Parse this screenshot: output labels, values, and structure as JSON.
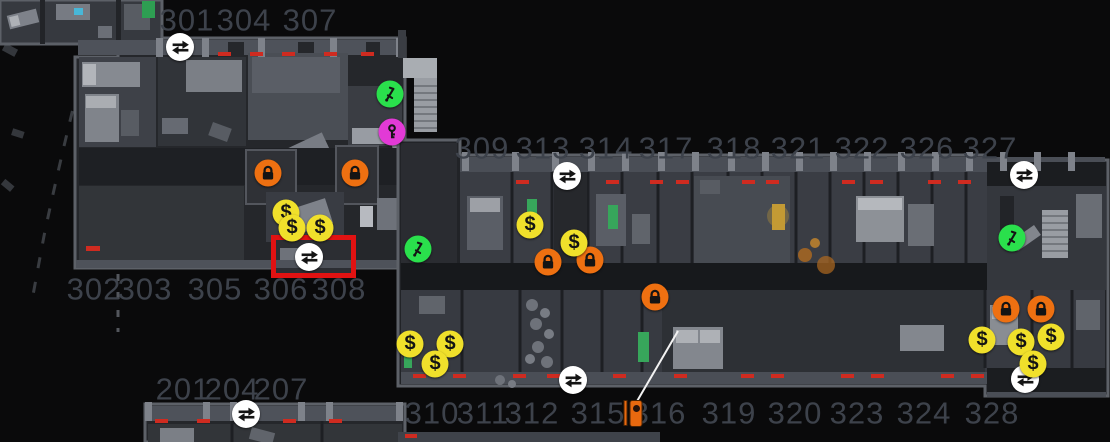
{
  "map": {
    "background": "#0a0a0b",
    "room_labels": [
      {
        "text": "301",
        "x": 187,
        "y": 20
      },
      {
        "text": "304",
        "x": 244,
        "y": 20
      },
      {
        "text": "307",
        "x": 310,
        "y": 20
      },
      {
        "text": "309",
        "x": 482,
        "y": 148
      },
      {
        "text": "313",
        "x": 543,
        "y": 148
      },
      {
        "text": "314",
        "x": 606,
        "y": 148
      },
      {
        "text": "317",
        "x": 666,
        "y": 148
      },
      {
        "text": "318",
        "x": 734,
        "y": 148
      },
      {
        "text": "321",
        "x": 798,
        "y": 148
      },
      {
        "text": "322",
        "x": 862,
        "y": 148
      },
      {
        "text": "326",
        "x": 927,
        "y": 148
      },
      {
        "text": "327",
        "x": 990,
        "y": 148
      },
      {
        "text": "302",
        "x": 94,
        "y": 289
      },
      {
        "text": "303",
        "x": 145,
        "y": 289
      },
      {
        "text": "305",
        "x": 215,
        "y": 289
      },
      {
        "text": "306",
        "x": 281,
        "y": 289
      },
      {
        "text": "308",
        "x": 339,
        "y": 289
      },
      {
        "text": "201",
        "x": 183,
        "y": 389
      },
      {
        "text": "204",
        "x": 232,
        "y": 389
      },
      {
        "text": "207",
        "x": 281,
        "y": 389
      },
      {
        "text": "310",
        "x": 432,
        "y": 413
      },
      {
        "text": "311",
        "x": 483,
        "y": 413
      },
      {
        "text": "312",
        "x": 532,
        "y": 413
      },
      {
        "text": "315",
        "x": 598,
        "y": 413
      },
      {
        "text": "316",
        "x": 659,
        "y": 413
      },
      {
        "text": "319",
        "x": 729,
        "y": 413
      },
      {
        "text": "320",
        "x": 795,
        "y": 413
      },
      {
        "text": "323",
        "x": 857,
        "y": 413
      },
      {
        "text": "324",
        "x": 924,
        "y": 413
      },
      {
        "text": "328",
        "x": 992,
        "y": 413
      }
    ],
    "icons": [
      {
        "type": "exchange",
        "x": 180,
        "y": 47
      },
      {
        "type": "exchange",
        "x": 309,
        "y": 257,
        "highlighted": true
      },
      {
        "type": "exchange",
        "x": 567,
        "y": 176
      },
      {
        "type": "exchange",
        "x": 573,
        "y": 380
      },
      {
        "type": "exchange",
        "x": 1024,
        "y": 175
      },
      {
        "type": "exchange",
        "x": 1025,
        "y": 379
      },
      {
        "type": "exchange",
        "x": 246,
        "y": 414
      },
      {
        "type": "lever",
        "x": 390,
        "y": 94
      },
      {
        "type": "lever",
        "x": 418,
        "y": 249
      },
      {
        "type": "lever",
        "x": 1012,
        "y": 238
      },
      {
        "type": "key",
        "x": 392,
        "y": 132
      },
      {
        "type": "lock",
        "x": 268,
        "y": 173
      },
      {
        "type": "lock",
        "x": 355,
        "y": 173
      },
      {
        "type": "lock",
        "x": 548,
        "y": 262
      },
      {
        "type": "lock",
        "x": 590,
        "y": 260
      },
      {
        "type": "lock",
        "x": 655,
        "y": 297
      },
      {
        "type": "lock",
        "x": 1006,
        "y": 309
      },
      {
        "type": "lock",
        "x": 1041,
        "y": 309
      },
      {
        "type": "money",
        "x": 286,
        "y": 213
      },
      {
        "type": "money",
        "x": 292,
        "y": 228
      },
      {
        "type": "money",
        "x": 320,
        "y": 228
      },
      {
        "type": "money",
        "x": 530,
        "y": 225
      },
      {
        "type": "money",
        "x": 574,
        "y": 243
      },
      {
        "type": "money",
        "x": 410,
        "y": 344
      },
      {
        "type": "money",
        "x": 450,
        "y": 344
      },
      {
        "type": "money",
        "x": 435,
        "y": 364
      },
      {
        "type": "money",
        "x": 982,
        "y": 340
      },
      {
        "type": "money",
        "x": 1021,
        "y": 342
      },
      {
        "type": "money",
        "x": 1051,
        "y": 337
      },
      {
        "type": "money",
        "x": 1033,
        "y": 364
      },
      {
        "type": "door",
        "x": 633,
        "y": 413
      }
    ],
    "icon_colors": {
      "exchange": "#ffffff",
      "lock": "#ee7011",
      "money": "#f0e02b",
      "lever": "#2ae04c",
      "key": "#e23ad6",
      "door": "#e8690f",
      "glyph": "#141414"
    },
    "money_symbol": "$",
    "highlight_box": {
      "x": 271,
      "y": 235,
      "width": 85,
      "height": 43,
      "color": "#e11212",
      "thickness": 5
    },
    "annotation_line": {
      "x1": 636,
      "y1": 403,
      "x2": 678,
      "y2": 331,
      "color": "#f2f2f2"
    }
  }
}
